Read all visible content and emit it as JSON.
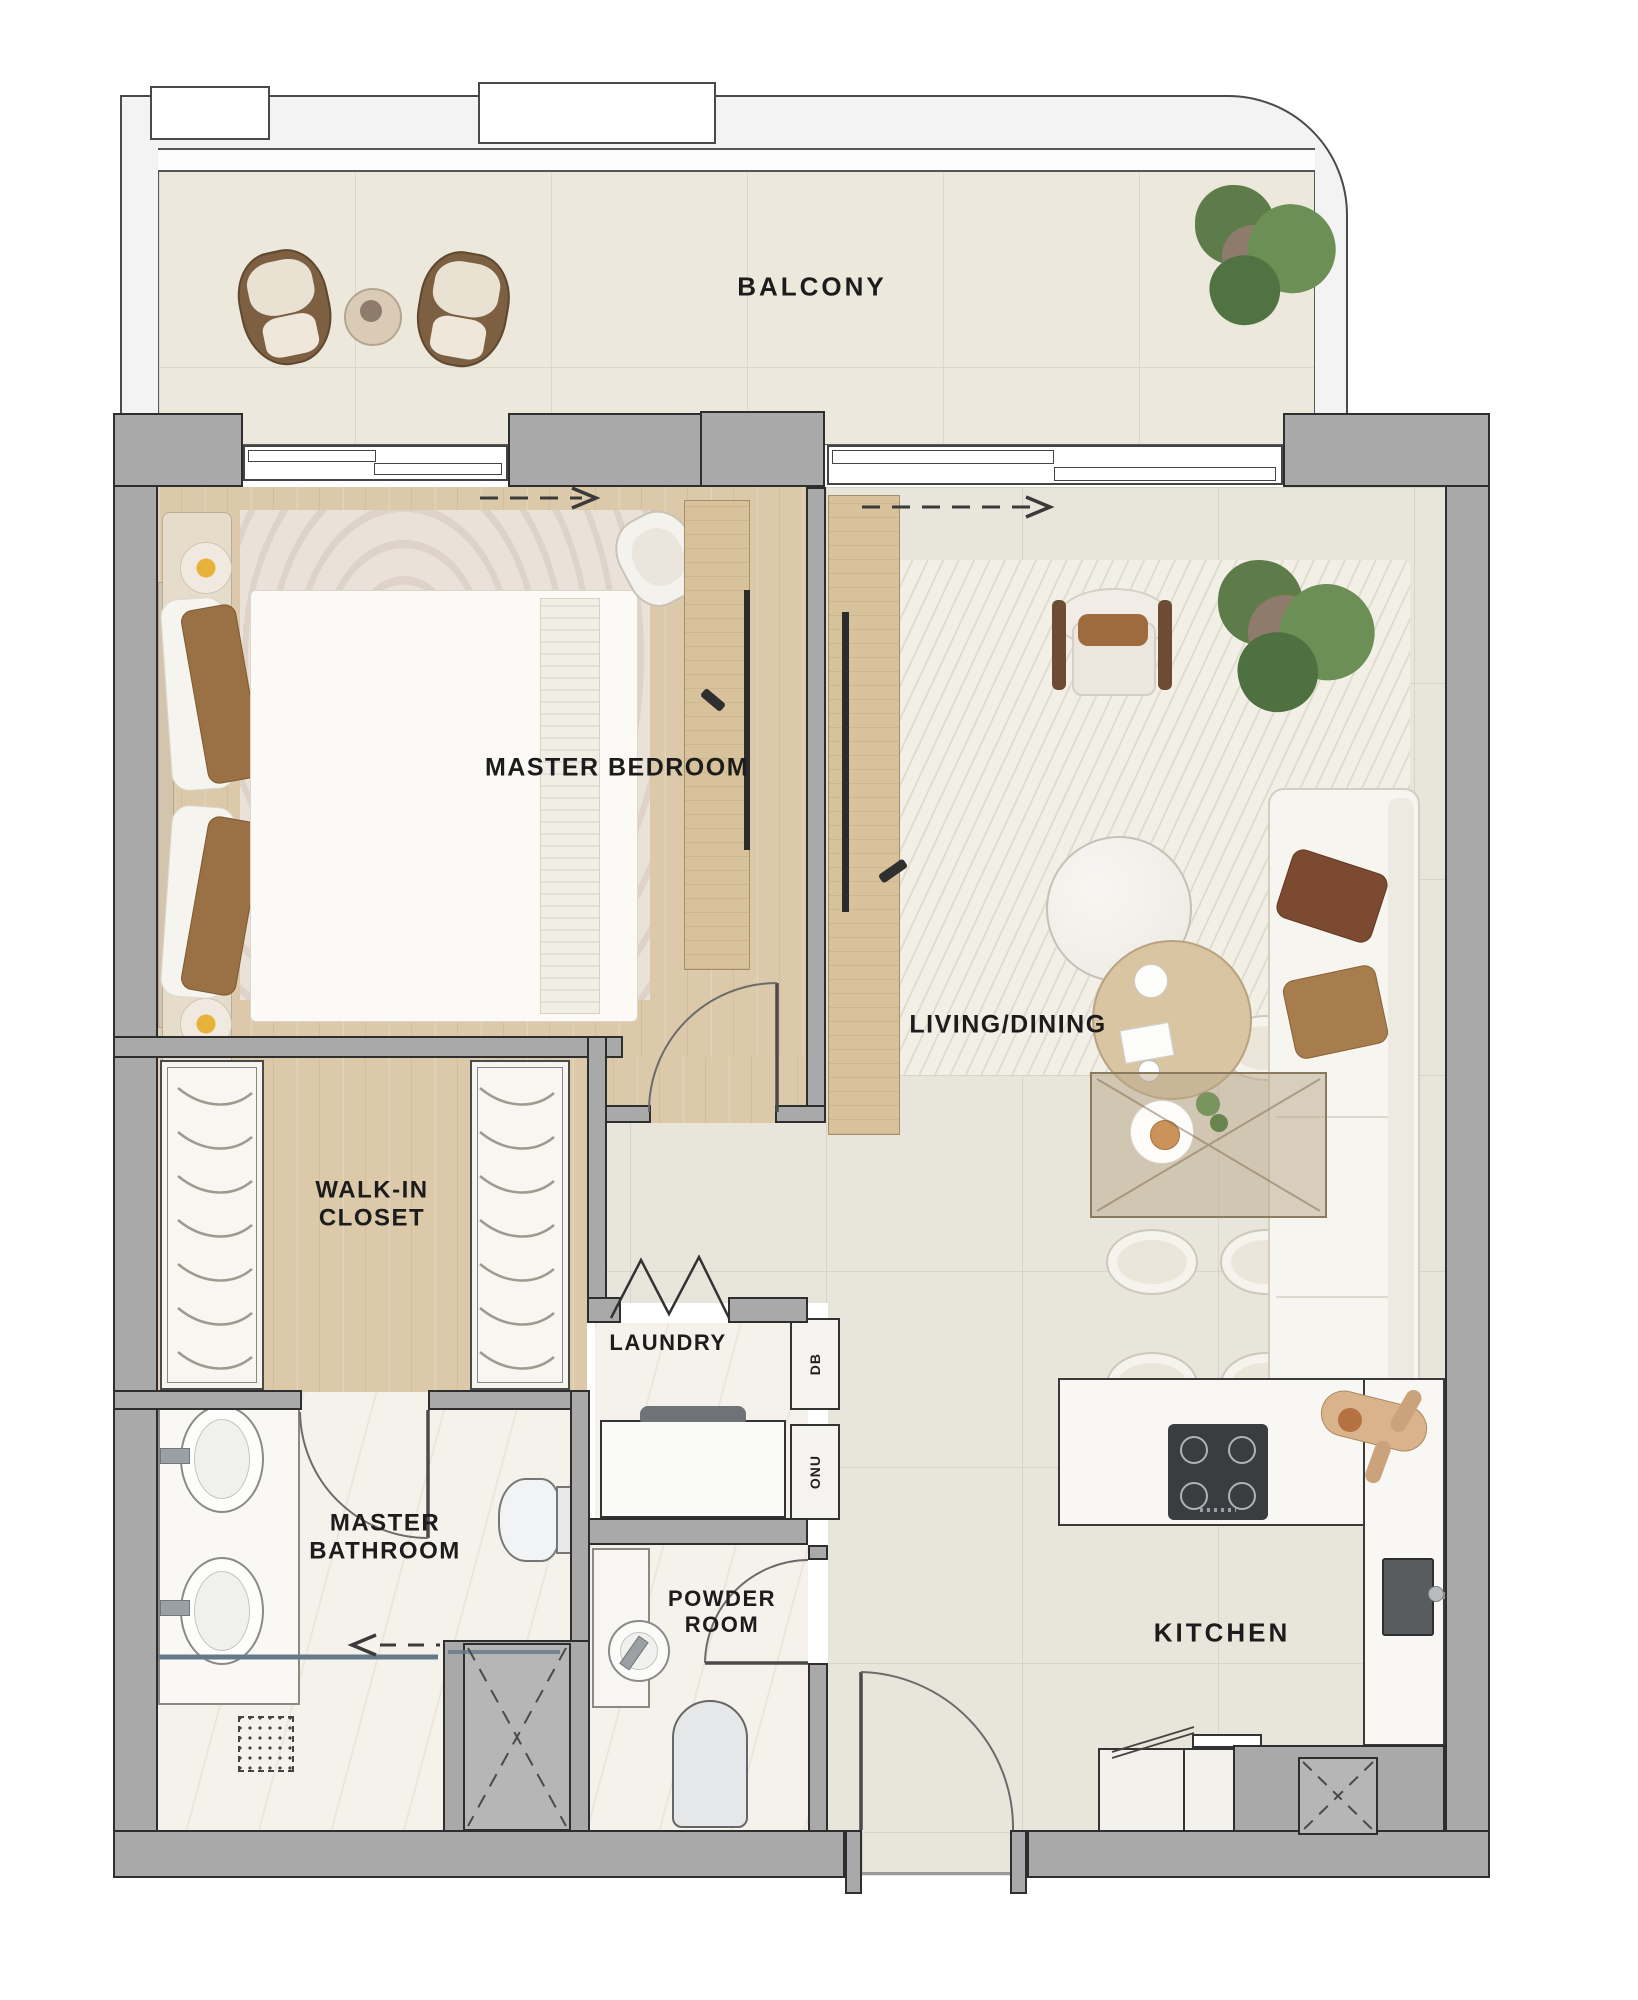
{
  "plan_title": "Apartment Floor Plan",
  "rooms": {
    "balcony": {
      "label": "BALCONY"
    },
    "master_bedroom": {
      "label": "MASTER BEDROOM"
    },
    "living_dining": {
      "label": "LIVING/DINING"
    },
    "walk_in_closet": {
      "label": "WALK-IN CLOSET"
    },
    "laundry": {
      "label": "LAUNDRY"
    },
    "master_bathroom": {
      "label": "MASTER BATHROOM"
    },
    "powder_room": {
      "label": "POWDER ROOM"
    },
    "kitchen": {
      "label": "KITCHEN"
    }
  },
  "utility": {
    "db": "DB",
    "onu": "ONU"
  },
  "colors": {
    "wall": "#a9a9a9",
    "wall_outline": "#2e2e2e",
    "wood_floor": "#dbc9a9",
    "tile_floor": "#e8e5da",
    "marble_floor": "#f5f2ec",
    "balcony_floor": "#ece8dc",
    "plant_green": "#5d7c4a",
    "pillow_brown": "#9a7144",
    "island_white": "#f8f7f4",
    "hob_dark": "#3a3c3f",
    "shower_glass": "#64798a"
  }
}
